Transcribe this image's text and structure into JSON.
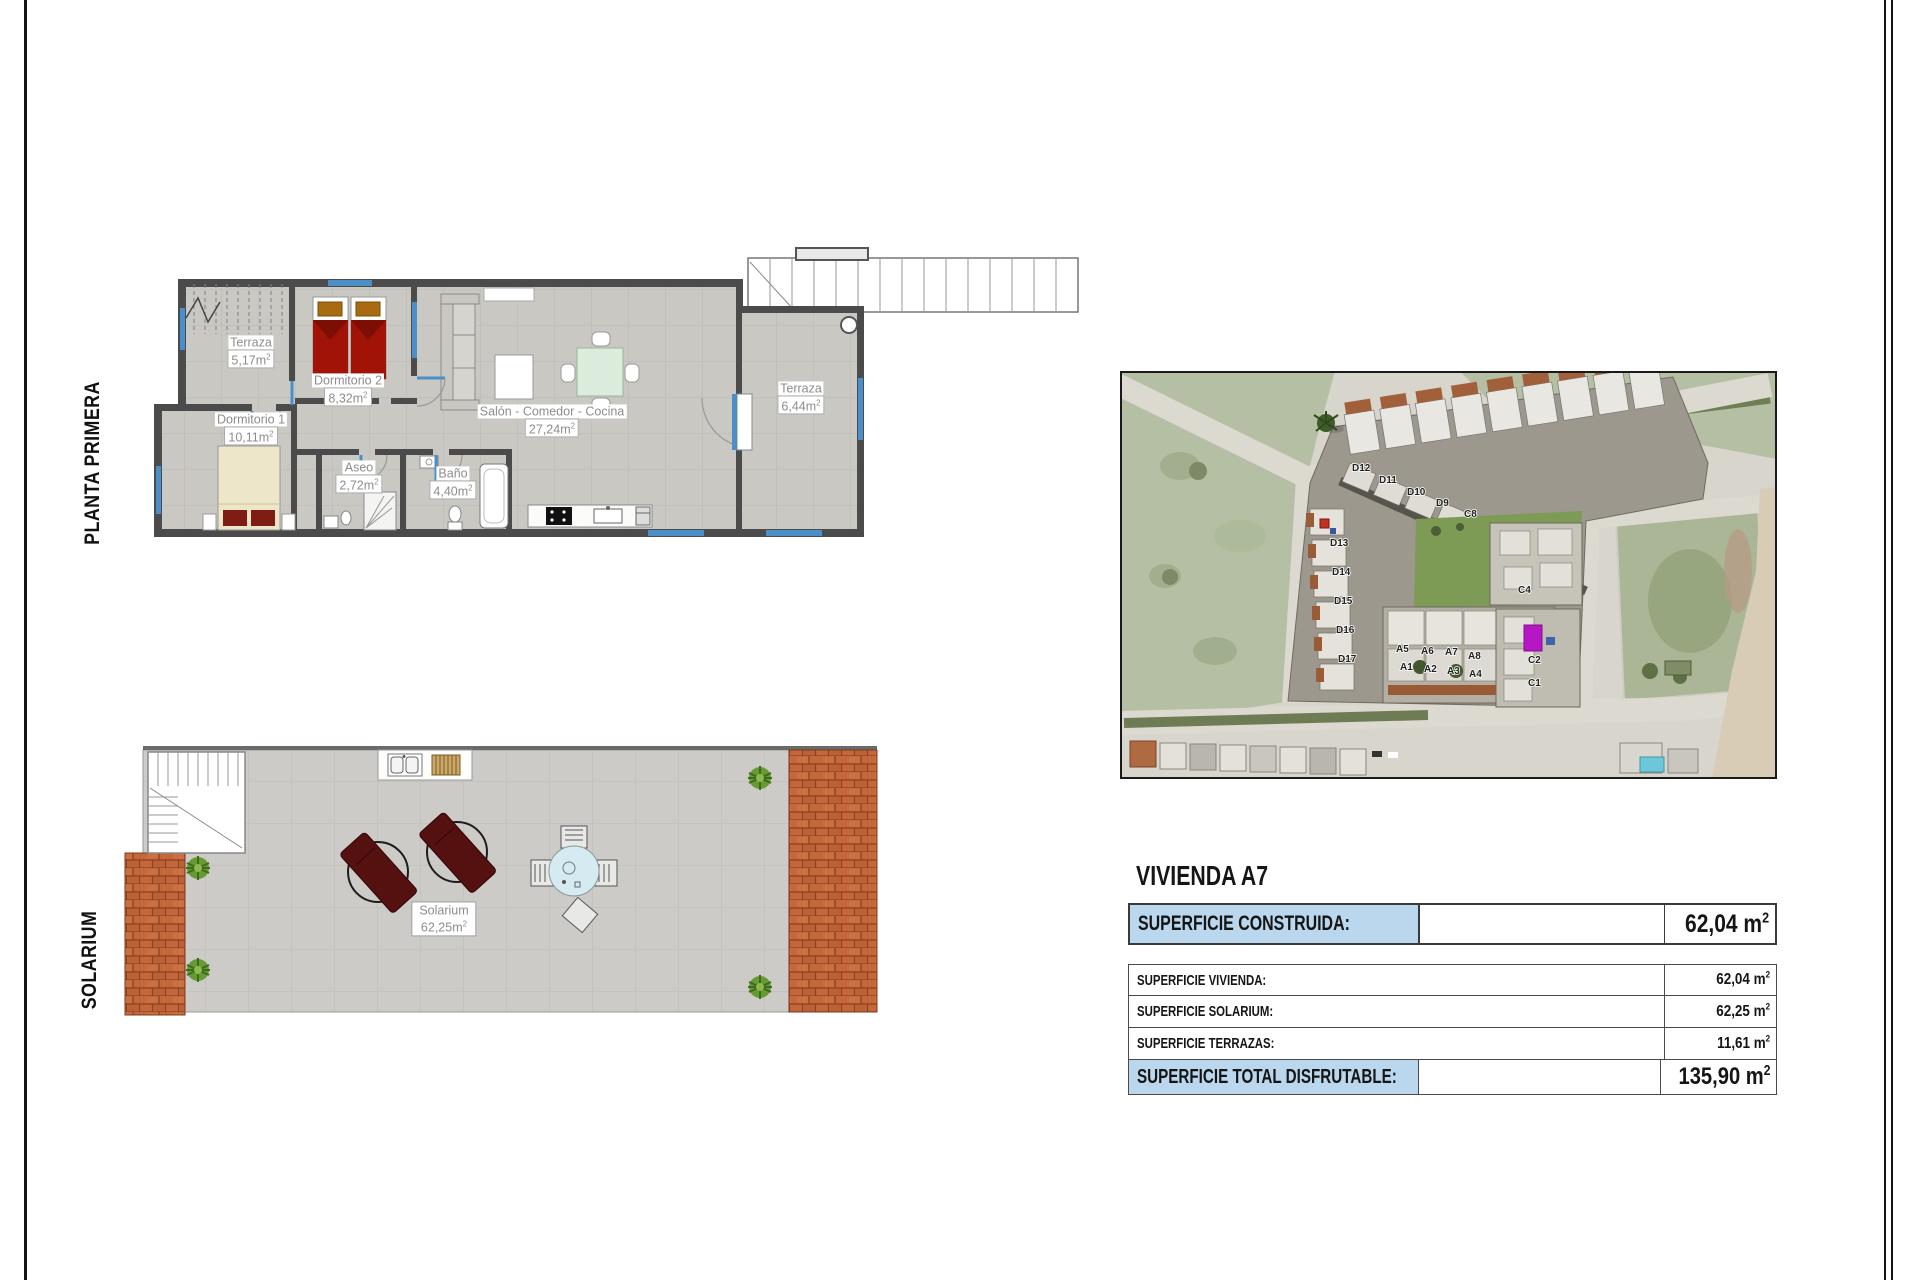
{
  "side_labels": {
    "planta": "PLANTA PRIMERA",
    "solarium": "SOLARIUM"
  },
  "units": {
    "sup": "2"
  },
  "planta_primera": {
    "rooms": [
      {
        "name": "Terraza",
        "area": "5,17m"
      },
      {
        "name": "Dormitorio 2",
        "area": "8,32m"
      },
      {
        "name": "Dormitorio 1",
        "area": "10,11m"
      },
      {
        "name": "Aseo",
        "area": "2,72m"
      },
      {
        "name": "Baño",
        "area": "4,40m"
      },
      {
        "name": "Salón - Comedor - Cocina",
        "area": "27,24m"
      },
      {
        "name": "Terraza",
        "area": "6,44m"
      }
    ]
  },
  "solarium": {
    "name": "Solarium",
    "area": "62,25m"
  },
  "site_map": {
    "labels": [
      {
        "t": "D12"
      },
      {
        "t": "D11"
      },
      {
        "t": "D10"
      },
      {
        "t": "D9"
      },
      {
        "t": "C8"
      },
      {
        "t": "D13"
      },
      {
        "t": "D14"
      },
      {
        "t": "D15"
      },
      {
        "t": "D16"
      },
      {
        "t": "D17"
      },
      {
        "t": "C4"
      },
      {
        "t": "C2"
      },
      {
        "t": "C1"
      },
      {
        "t": "A5"
      },
      {
        "t": "A6"
      },
      {
        "t": "A7"
      },
      {
        "t": "A8"
      },
      {
        "t": "A1"
      },
      {
        "t": "A2"
      },
      {
        "t": "A3"
      },
      {
        "t": "A4"
      }
    ]
  },
  "details": {
    "title": "VIVIENDA A7",
    "header": {
      "label": "SUPERFICIE CONSTRUIDA:",
      "value": "62,04 m"
    },
    "rows": [
      {
        "label": "SUPERFICIE VIVIENDA:",
        "value": "62,04 m"
      },
      {
        "label": "SUPERFICIE SOLARIUM:",
        "value": "62,25 m"
      },
      {
        "label": "SUPERFICIE TERRAZAS:",
        "value": "11,61 m"
      }
    ],
    "total": {
      "label": "SUPERFICIE TOTAL DISFRUTABLE:",
      "value": "135,90 m"
    }
  },
  "colors": {
    "table_highlight": "#bad7ee",
    "window_blue": "#4a8fc7",
    "bed_red": "#a11307",
    "roof_tile": "#c4683c",
    "pool": "#7fd2e2",
    "highlight_magenta": "#b517c4"
  }
}
